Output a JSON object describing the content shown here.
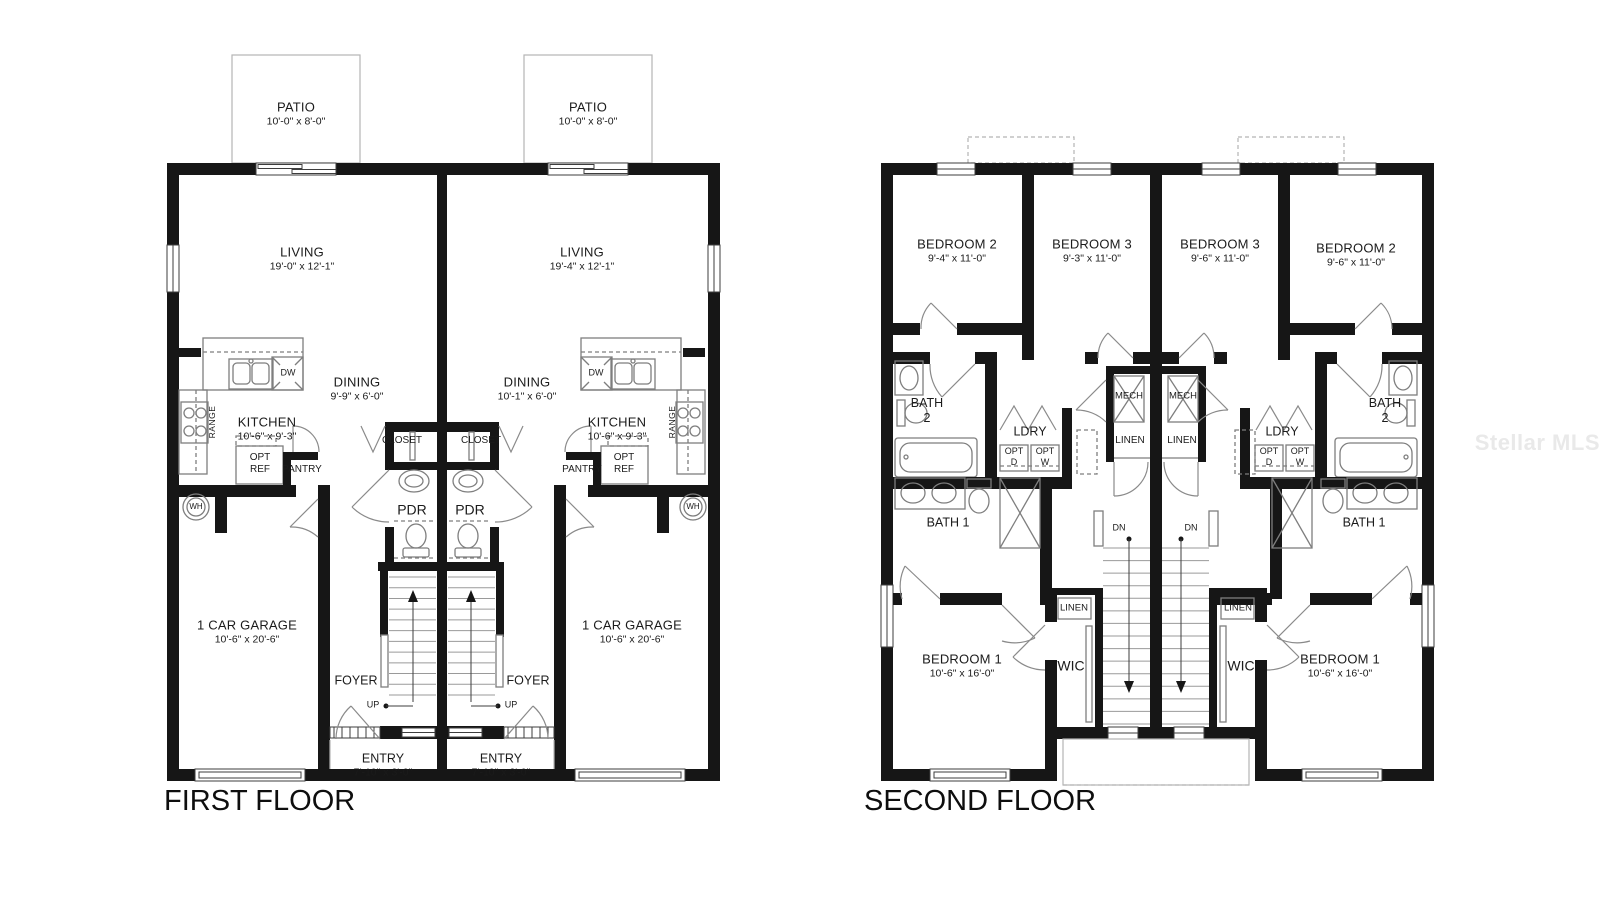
{
  "watermark": "Stellar MLS",
  "first_floor": {
    "title": "FIRST FLOOR",
    "unit_a": {
      "patio": {
        "name": "PATIO",
        "dims": "10'-0\" x 8'-0\""
      },
      "living": {
        "name": "LIVING",
        "dims": "19'-0\" x 12'-1\""
      },
      "dining": {
        "name": "DINING",
        "dims": "9'-9\" x 6'-0\""
      },
      "kitchen": {
        "name": "KITCHEN",
        "dims": "10'-6\" x 9'-3\""
      },
      "garage": {
        "name": "1 CAR GARAGE",
        "dims": "10'-6\" x 20'-6\""
      },
      "entry": {
        "name": "ENTRY",
        "dims": "7'-10\" x 3'-0\""
      },
      "range": "RANGE",
      "dw": "DW",
      "opt_ref": "OPT\nREF",
      "pantry": "PANTRY",
      "wh": "WH",
      "closet": "CLOSET",
      "pdr": "PDR",
      "foyer": "FOYER",
      "up": "UP"
    },
    "unit_b": {
      "patio": {
        "name": "PATIO",
        "dims": "10'-0\" x 8'-0\""
      },
      "living": {
        "name": "LIVING",
        "dims": "19'-4\" x 12'-1\""
      },
      "dining": {
        "name": "DINING",
        "dims": "10'-1\" x 6'-0\""
      },
      "kitchen": {
        "name": "KITCHEN",
        "dims": "10'-6\" x 9'-3\""
      },
      "garage": {
        "name": "1 CAR GARAGE",
        "dims": "10'-6\" x 20'-6\""
      },
      "entry": {
        "name": "ENTRY",
        "dims": "7'-10\" x 3'-0\""
      },
      "range": "RANGE",
      "dw": "DW",
      "opt_ref": "OPT\nREF",
      "pantry": "PANTRY",
      "wh": "WH",
      "closet": "CLOSET",
      "pdr": "PDR",
      "foyer": "FOYER",
      "up": "UP"
    }
  },
  "second_floor": {
    "title": "SECOND FLOOR",
    "unit_a": {
      "bedroom2": {
        "name": "BEDROOM 2",
        "dims": "9'-4\" x 11'-0\""
      },
      "bedroom3": {
        "name": "BEDROOM 3",
        "dims": "9'-3\" x 11'-0\""
      },
      "bedroom1": {
        "name": "BEDROOM 1",
        "dims": "10'-6\" x 16'-0\""
      },
      "bath2": "BATH\n2",
      "ldry": "LDRY",
      "opt_d": "OPT\nD",
      "opt_w": "OPT\nW",
      "mech": "MECH",
      "linen": "LINEN",
      "bath1": "BATH 1",
      "dn": "DN",
      "linen2": "LINEN",
      "wic": "WIC"
    },
    "unit_b": {
      "bedroom3": {
        "name": "BEDROOM 3",
        "dims": "9'-6\" x 11'-0\""
      },
      "bedroom2": {
        "name": "BEDROOM 2",
        "dims": "9'-6\" x 11'-0\""
      },
      "bedroom1": {
        "name": "BEDROOM 1",
        "dims": "10'-6\" x 16'-0\""
      },
      "bath2": "BATH\n2",
      "ldry": "LDRY",
      "opt_d": "OPT\nD",
      "opt_w": "OPT\nW",
      "mech": "MECH",
      "linen": "LINEN",
      "bath1": "BATH 1",
      "dn": "DN",
      "linen2": "LINEN",
      "wic": "WIC"
    }
  }
}
